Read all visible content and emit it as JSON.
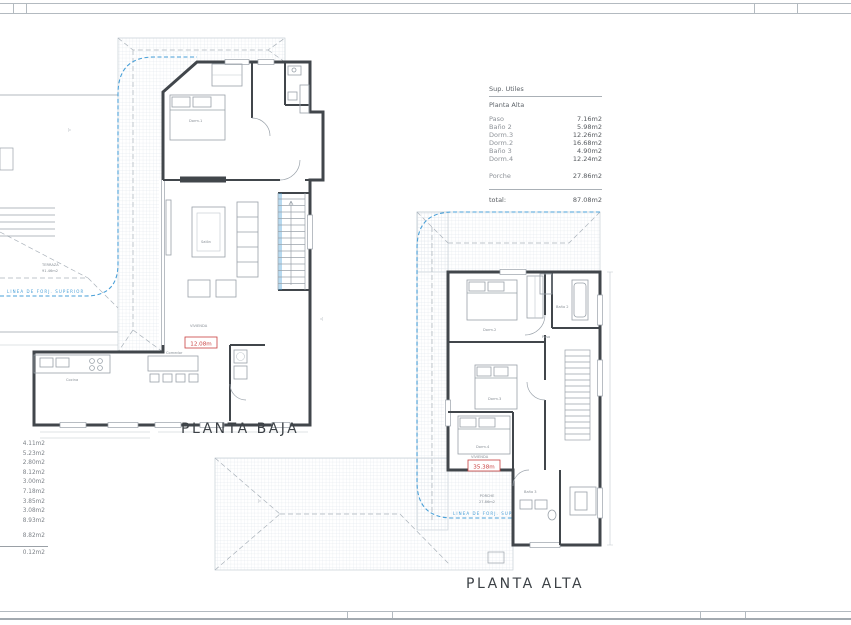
{
  "colors": {
    "blue": "#4aa0d8",
    "red": "#c94040",
    "wall": "#41464b"
  },
  "area_table": {
    "title": "Sup. Utiles",
    "section": "Planta Alta",
    "rows": [
      {
        "label": "Paso",
        "value": "7.16m2"
      },
      {
        "label": "Baño 2",
        "value": "5.98m2"
      },
      {
        "label": "Dorm.3",
        "value": "12.26m2"
      },
      {
        "label": "Dorm.2",
        "value": "16.68m2"
      },
      {
        "label": "Baño 3",
        "value": "4.90m2"
      },
      {
        "label": "Dorm.4",
        "value": "12.24m2"
      }
    ],
    "porche": {
      "label": "Porche",
      "value": "27.86m2"
    },
    "total": {
      "label": "total:",
      "value": "87.08m2"
    }
  },
  "left_list": {
    "values": [
      "4.11m2",
      "5.23m2",
      "2.80m2",
      "8.12m2",
      "3.00m2",
      "7.18m2",
      "3.85m2",
      "3.08m2",
      "8.93m2"
    ],
    "subtotal": "8.82m2",
    "total": "0.12m2"
  },
  "planta_baja": {
    "title": "PLANTA BAJA",
    "linea": "LINEA DE FORJ. SUPERIOR",
    "terraza": "TERRAZA",
    "terraza_area": "91.46m2",
    "vivienda": "VIVIENDA",
    "superficie": "12.08m",
    "rooms": {
      "dorm1": "Dorm.1",
      "salon": "Salón",
      "comedor": "Comedor",
      "cocina": "Cocina"
    }
  },
  "planta_alta": {
    "title": "PLANTA ALTA",
    "linea": "LINEA DE FORJ. SUPERIOR",
    "porche": "PORCHE",
    "porche_area": "27.86m2",
    "vivienda": "VIVIENDA",
    "superficie": "35.38m",
    "rooms": {
      "dorm2": "Dorm.2",
      "bano2": "Baño 2",
      "paso": "Paso",
      "dorm3": "Dorm.3",
      "dorm4": "Dorm.4",
      "bano3": "Baño 3"
    }
  }
}
